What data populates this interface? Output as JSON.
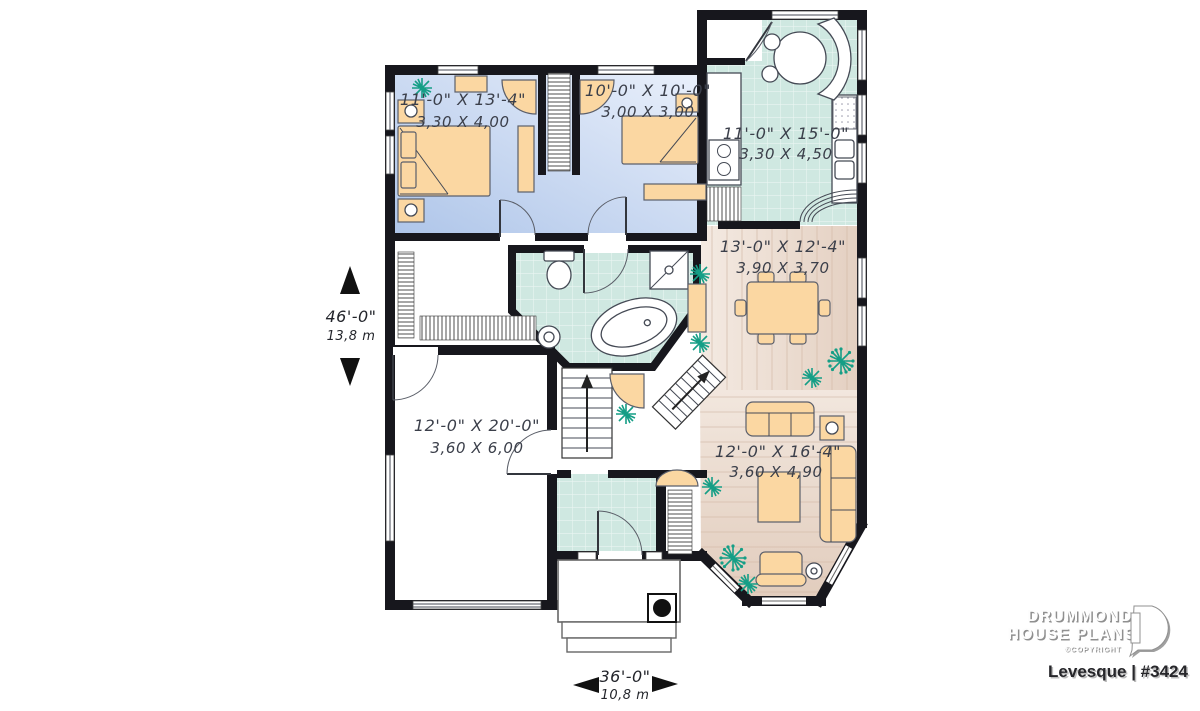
{
  "rooms": {
    "bedroom1": {
      "imperial": "11'-0\" X 13'-4\"",
      "metric": "3,30 X 4,00"
    },
    "bedroom2": {
      "imperial": "10'-0\" X 10'-0\"",
      "metric": "3,00 X 3,00"
    },
    "kitchen": {
      "imperial": "11'-0\" X 15'-0\"",
      "metric": "3,30 X 4,50"
    },
    "dining": {
      "imperial": "13'-0\" X 12'-4\"",
      "metric": "3,90 X 3,70"
    },
    "living": {
      "imperial": "12'-0\" X 16'-4\"",
      "metric": "3,60 X 4,90"
    },
    "garage": {
      "imperial": "12'-0\" X 20'-0\"",
      "metric": "3,60 X 6,00"
    }
  },
  "overall_dimensions": {
    "depth": {
      "imperial": "46'-0\"",
      "metric": "13,8 m"
    },
    "width": {
      "imperial": "36'-0\"",
      "metric": "10,8 m"
    }
  },
  "branding": {
    "name_line1": "DRUMMOND",
    "name_line2": "HOUSE PLANS",
    "copyright": "©COPYRIGHT",
    "plan_id": "Levesque | #3424"
  },
  "colors": {
    "wall": "#17171d",
    "tile_floor": "#cfe8e1",
    "bedroom_floor": "#b9cdee",
    "wood_floor": "#f3e9e1",
    "furniture": "#fbd7a2",
    "plant": "#159e86",
    "label_text": "#3b3f4a"
  }
}
